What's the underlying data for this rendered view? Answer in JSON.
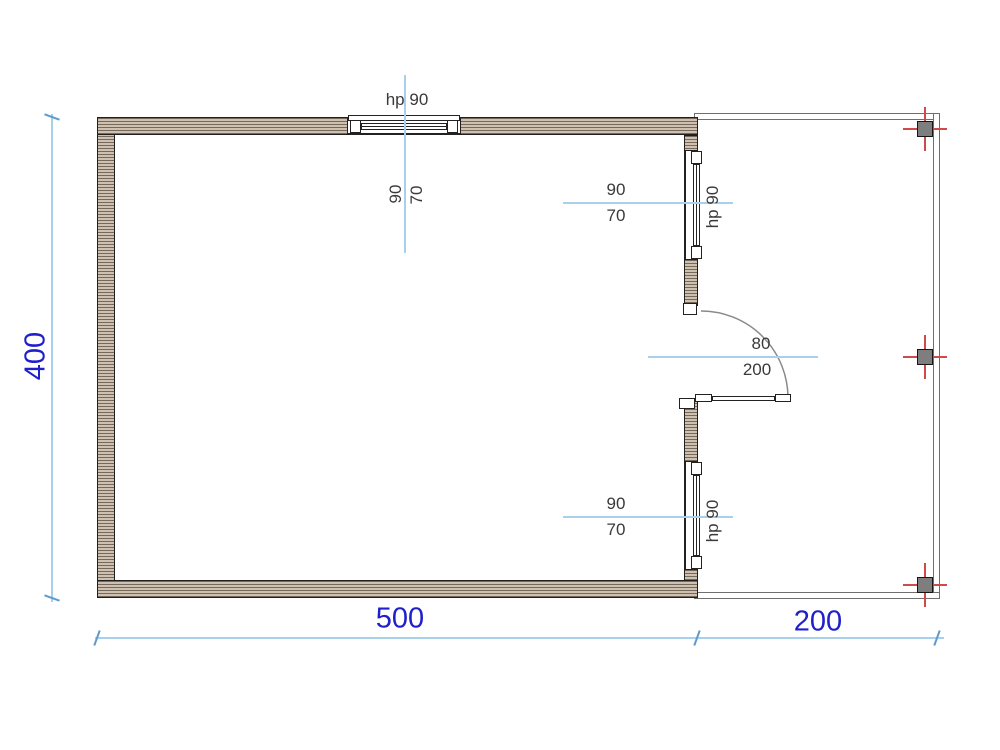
{
  "colors": {
    "wall_fill": "#cec1b1",
    "wall_hatch_line": "#77695a",
    "wall_outline": "#1f1f1f",
    "frame_outline": "#222222",
    "porch_outline": "#6f6f6f",
    "column_fill": "#7e7e7e",
    "column_outline": "#161616",
    "axis_mark": "#cf4a4a",
    "door_arc": "#8a8a8a",
    "dim_text": "#2020cb",
    "dim_line": "#a9d0ea",
    "dim_tick": "#5d9bcd",
    "annotation_text": "#3a3a3a"
  },
  "dimensions": {
    "height_value": "400",
    "main_width_value": "500",
    "porch_width_value": "200"
  },
  "top_window": {
    "hp_label": "hp 90",
    "width_label": "90",
    "height_label": "70"
  },
  "right_window_top": {
    "hp_label": "hp 90",
    "width_label": "90",
    "height_label": "70"
  },
  "right_window_bottom": {
    "hp_label": "hp 90",
    "width_label": "90",
    "height_label": "70"
  },
  "door": {
    "width_label": "80",
    "height_label": "200"
  }
}
